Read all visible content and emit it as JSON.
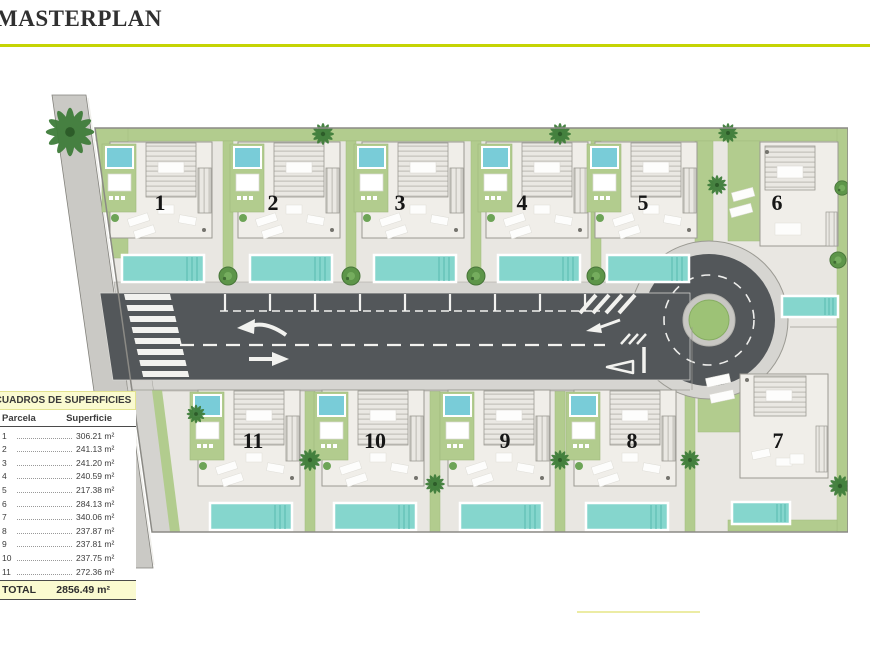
{
  "title": "MASTERPLAN",
  "plan": {
    "plot_labels": [
      "1",
      "2",
      "3",
      "4",
      "5",
      "6",
      "7",
      "8",
      "9",
      "10",
      "11"
    ]
  },
  "surface_table": {
    "header": "CUADROS DE SUPERFICIES",
    "columns": {
      "parcela": "Parcela",
      "superficie": "Superficie"
    },
    "rows": [
      {
        "parcela": "1",
        "superficie": "306.21 m²"
      },
      {
        "parcela": "2",
        "superficie": "241.13 m²"
      },
      {
        "parcela": "3",
        "superficie": "241.20 m²"
      },
      {
        "parcela": "4",
        "superficie": "240.59 m²"
      },
      {
        "parcela": "5",
        "superficie": "217.38 m²"
      },
      {
        "parcela": "6",
        "superficie": "284.13 m²"
      },
      {
        "parcela": "7",
        "superficie": "340.06 m²"
      },
      {
        "parcela": "8",
        "superficie": "237.87 m²"
      },
      {
        "parcela": "9",
        "superficie": "237.81 m²"
      },
      {
        "parcela": "10",
        "superficie": "237.75 m²"
      },
      {
        "parcela": "11",
        "superficie": "272.36 m²"
      }
    ],
    "total_label": "TOTAL",
    "total_value": "2856.49 m²"
  },
  "colors": {
    "accent_line": "#c5d404",
    "grass": "#b2cc8e",
    "road_asphalt": "#53575a",
    "pool": "#85d6cd",
    "table_highlight": "#fafad0"
  }
}
